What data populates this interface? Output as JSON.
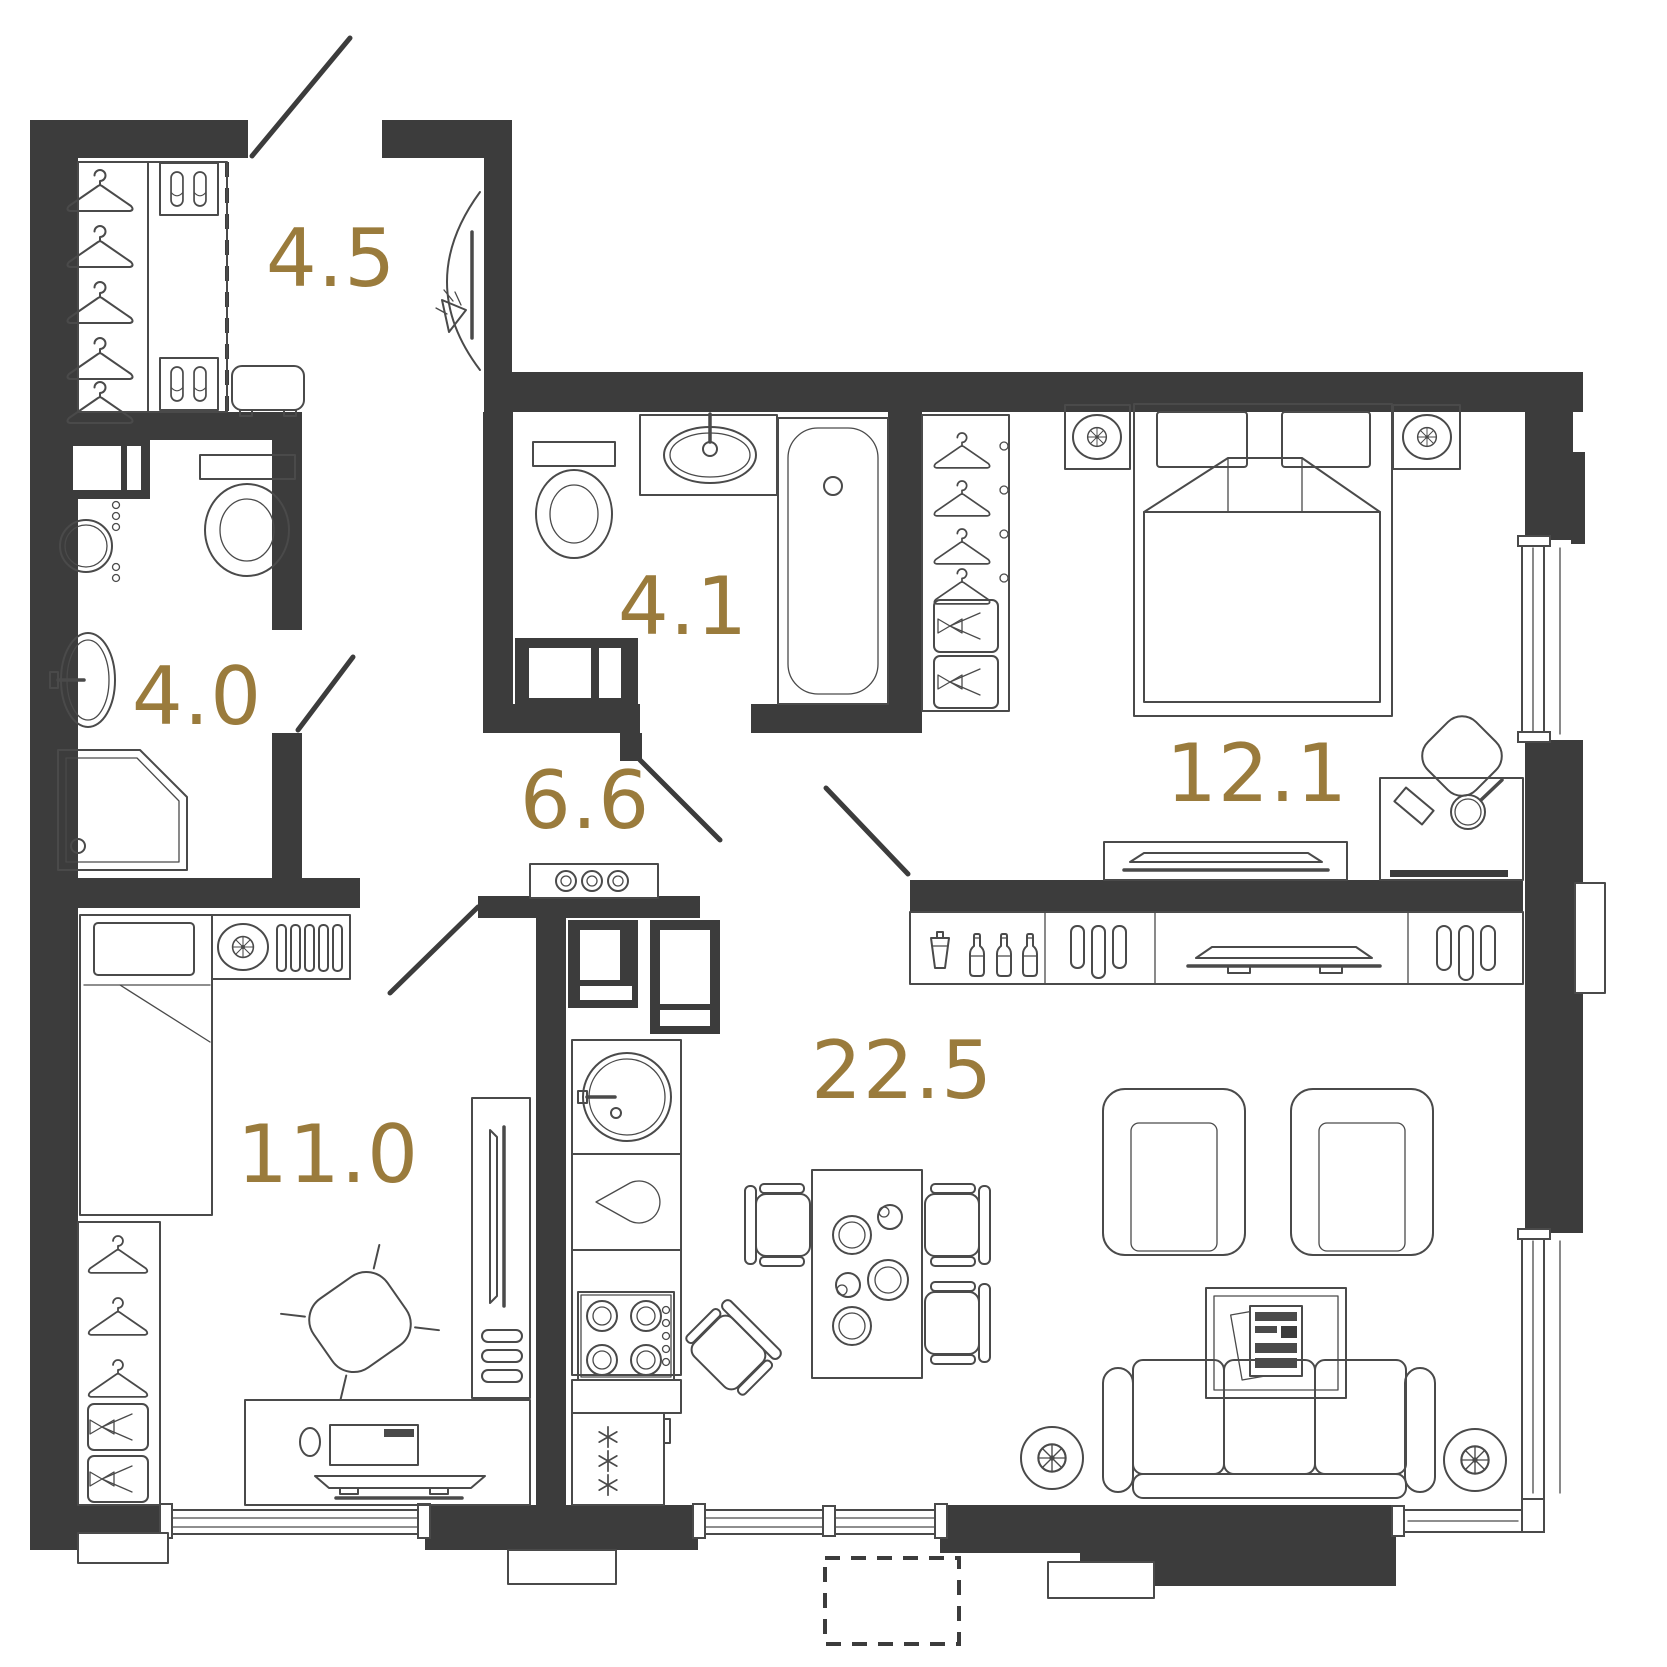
{
  "meta": {
    "type": "apartment-floor-plan",
    "units": "m2"
  },
  "palette": {
    "wall": "#3c3c3c",
    "line": "#4a4a4a",
    "label": "#9a7b3c",
    "bg": "#ffffff"
  },
  "rooms": [
    {
      "id": "entry-hall",
      "area": "4.5",
      "fixtures": [
        "hangers",
        "shoe-boxes",
        "bench",
        "mirror-with-sconce"
      ]
    },
    {
      "id": "bathroom",
      "area": "4.0",
      "fixtures": [
        "washing-machine",
        "toilet",
        "water-heater",
        "sink",
        "shower"
      ]
    },
    {
      "id": "bathroom-2",
      "area": "4.1",
      "fixtures": [
        "toilet",
        "sink",
        "bathtub",
        "washing-machine"
      ]
    },
    {
      "id": "corridor",
      "area": "6.6",
      "fixtures": []
    },
    {
      "id": "bedroom",
      "area": "12.1",
      "fixtures": [
        "wardrobe",
        "double-bed",
        "nightstand-lamps",
        "tv-console",
        "vanity-table",
        "chair"
      ]
    },
    {
      "id": "room",
      "area": "11.0",
      "fixtures": [
        "single-bed",
        "nightstand-radiator",
        "wardrobe",
        "desk",
        "office-chair",
        "tv-unit"
      ]
    },
    {
      "id": "kitchen-living-room",
      "area": "22.5",
      "fixtures": [
        "cooker-hood",
        "fridge",
        "tall-cabinet",
        "sink",
        "hob",
        "freezer",
        "dining-table",
        "chairs",
        "bar-sideboard",
        "tv-console",
        "armchairs",
        "coffee-table",
        "sofa",
        "floor-lamps"
      ]
    }
  ]
}
